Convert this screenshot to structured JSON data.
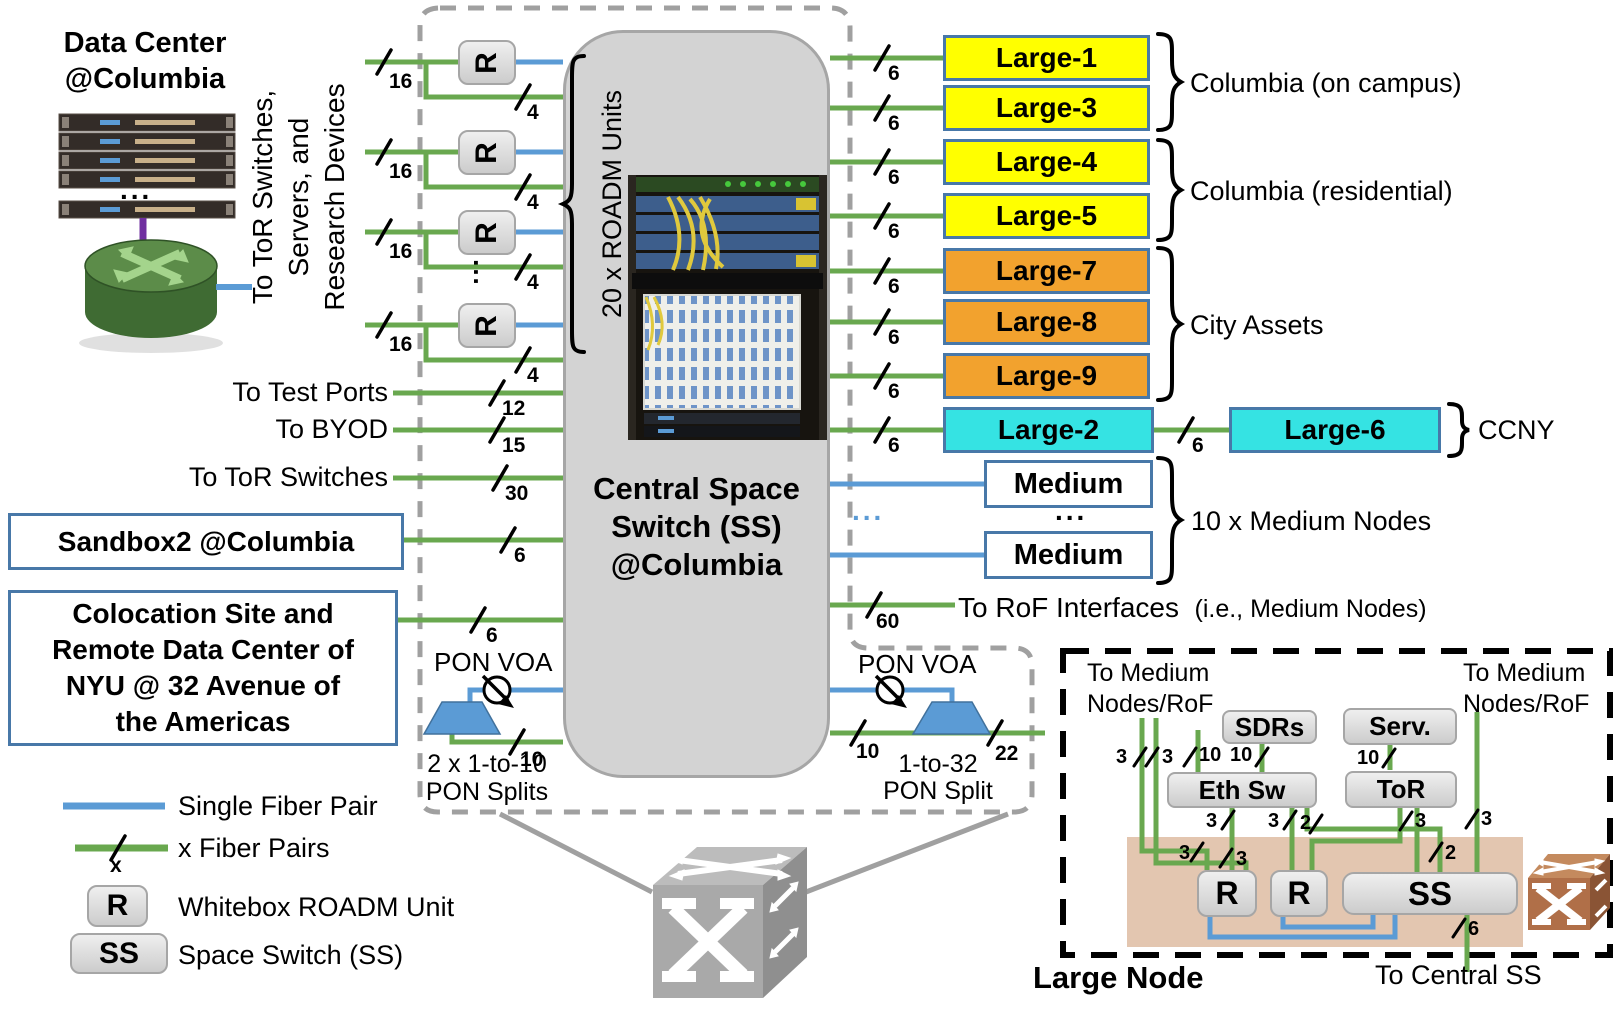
{
  "counts": {
    "c2": "2",
    "c3": "3",
    "c4": "4",
    "c6": "6",
    "c10": "10",
    "c12": "12",
    "c15": "15",
    "c16": "16",
    "c22": "22",
    "c30": "30",
    "c60": "60",
    "x": "x"
  },
  "misc": {
    "dots": "...",
    "r": "R"
  },
  "datacenter": {
    "title": "Data Center @Columbia"
  },
  "rotated": {
    "line1": "To ToR Switches,",
    "line2": "Servers, and",
    "line3": "Research Devices",
    "roadm": "20 x ROADM Units"
  },
  "central": {
    "line1": "Central Space",
    "line2": "Switch (SS)",
    "line3": "@Columbia"
  },
  "left_ports": {
    "test": "To Test Ports",
    "byod": "To BYOD",
    "tor": "To ToR Switches",
    "sandbox": "Sandbox2 @Columbia",
    "colo1": "Colocation Site and",
    "colo2": "Remote Data Center of",
    "colo3": "NYU @ 32 Avenue of",
    "colo4": "the Americas"
  },
  "pon": {
    "left_voa": "PON VOA",
    "right_voa": "PON VOA",
    "left1": "2 x 1-to-10",
    "left2": "PON Splits",
    "right1": "1-to-32",
    "right2": "PON Split"
  },
  "nodes": {
    "l1": "Large-1",
    "l3": "Large-3",
    "l4": "Large-4",
    "l5": "Large-5",
    "l7": "Large-7",
    "l8": "Large-8",
    "l9": "Large-9",
    "l2": "Large-2",
    "l6": "Large-6",
    "medium": "Medium"
  },
  "groups": {
    "campus": "Columbia (on campus)",
    "residential": "Columbia (residential)",
    "city": "City Assets",
    "ccny": "CCNY",
    "medium": "10 x Medium Nodes"
  },
  "rof": {
    "main": "To RoF Interfaces",
    "sub": "(i.e., Medium Nodes)"
  },
  "legend": {
    "single": "Single Fiber Pair",
    "multi": "x Fiber Pairs",
    "r": "R",
    "r_label": "Whitebox ROADM Unit",
    "ss": "SS",
    "ss_label": "Space Switch (SS)"
  },
  "inset": {
    "title": "Large Node",
    "tm1": "To Medium",
    "tm2": "Nodes/RoF",
    "sdrs": "SDRs",
    "serv": "Serv.",
    "ethsw": "Eth Sw",
    "tor": "ToR",
    "r": "R",
    "ss": "SS",
    "central": "To Central SS"
  }
}
